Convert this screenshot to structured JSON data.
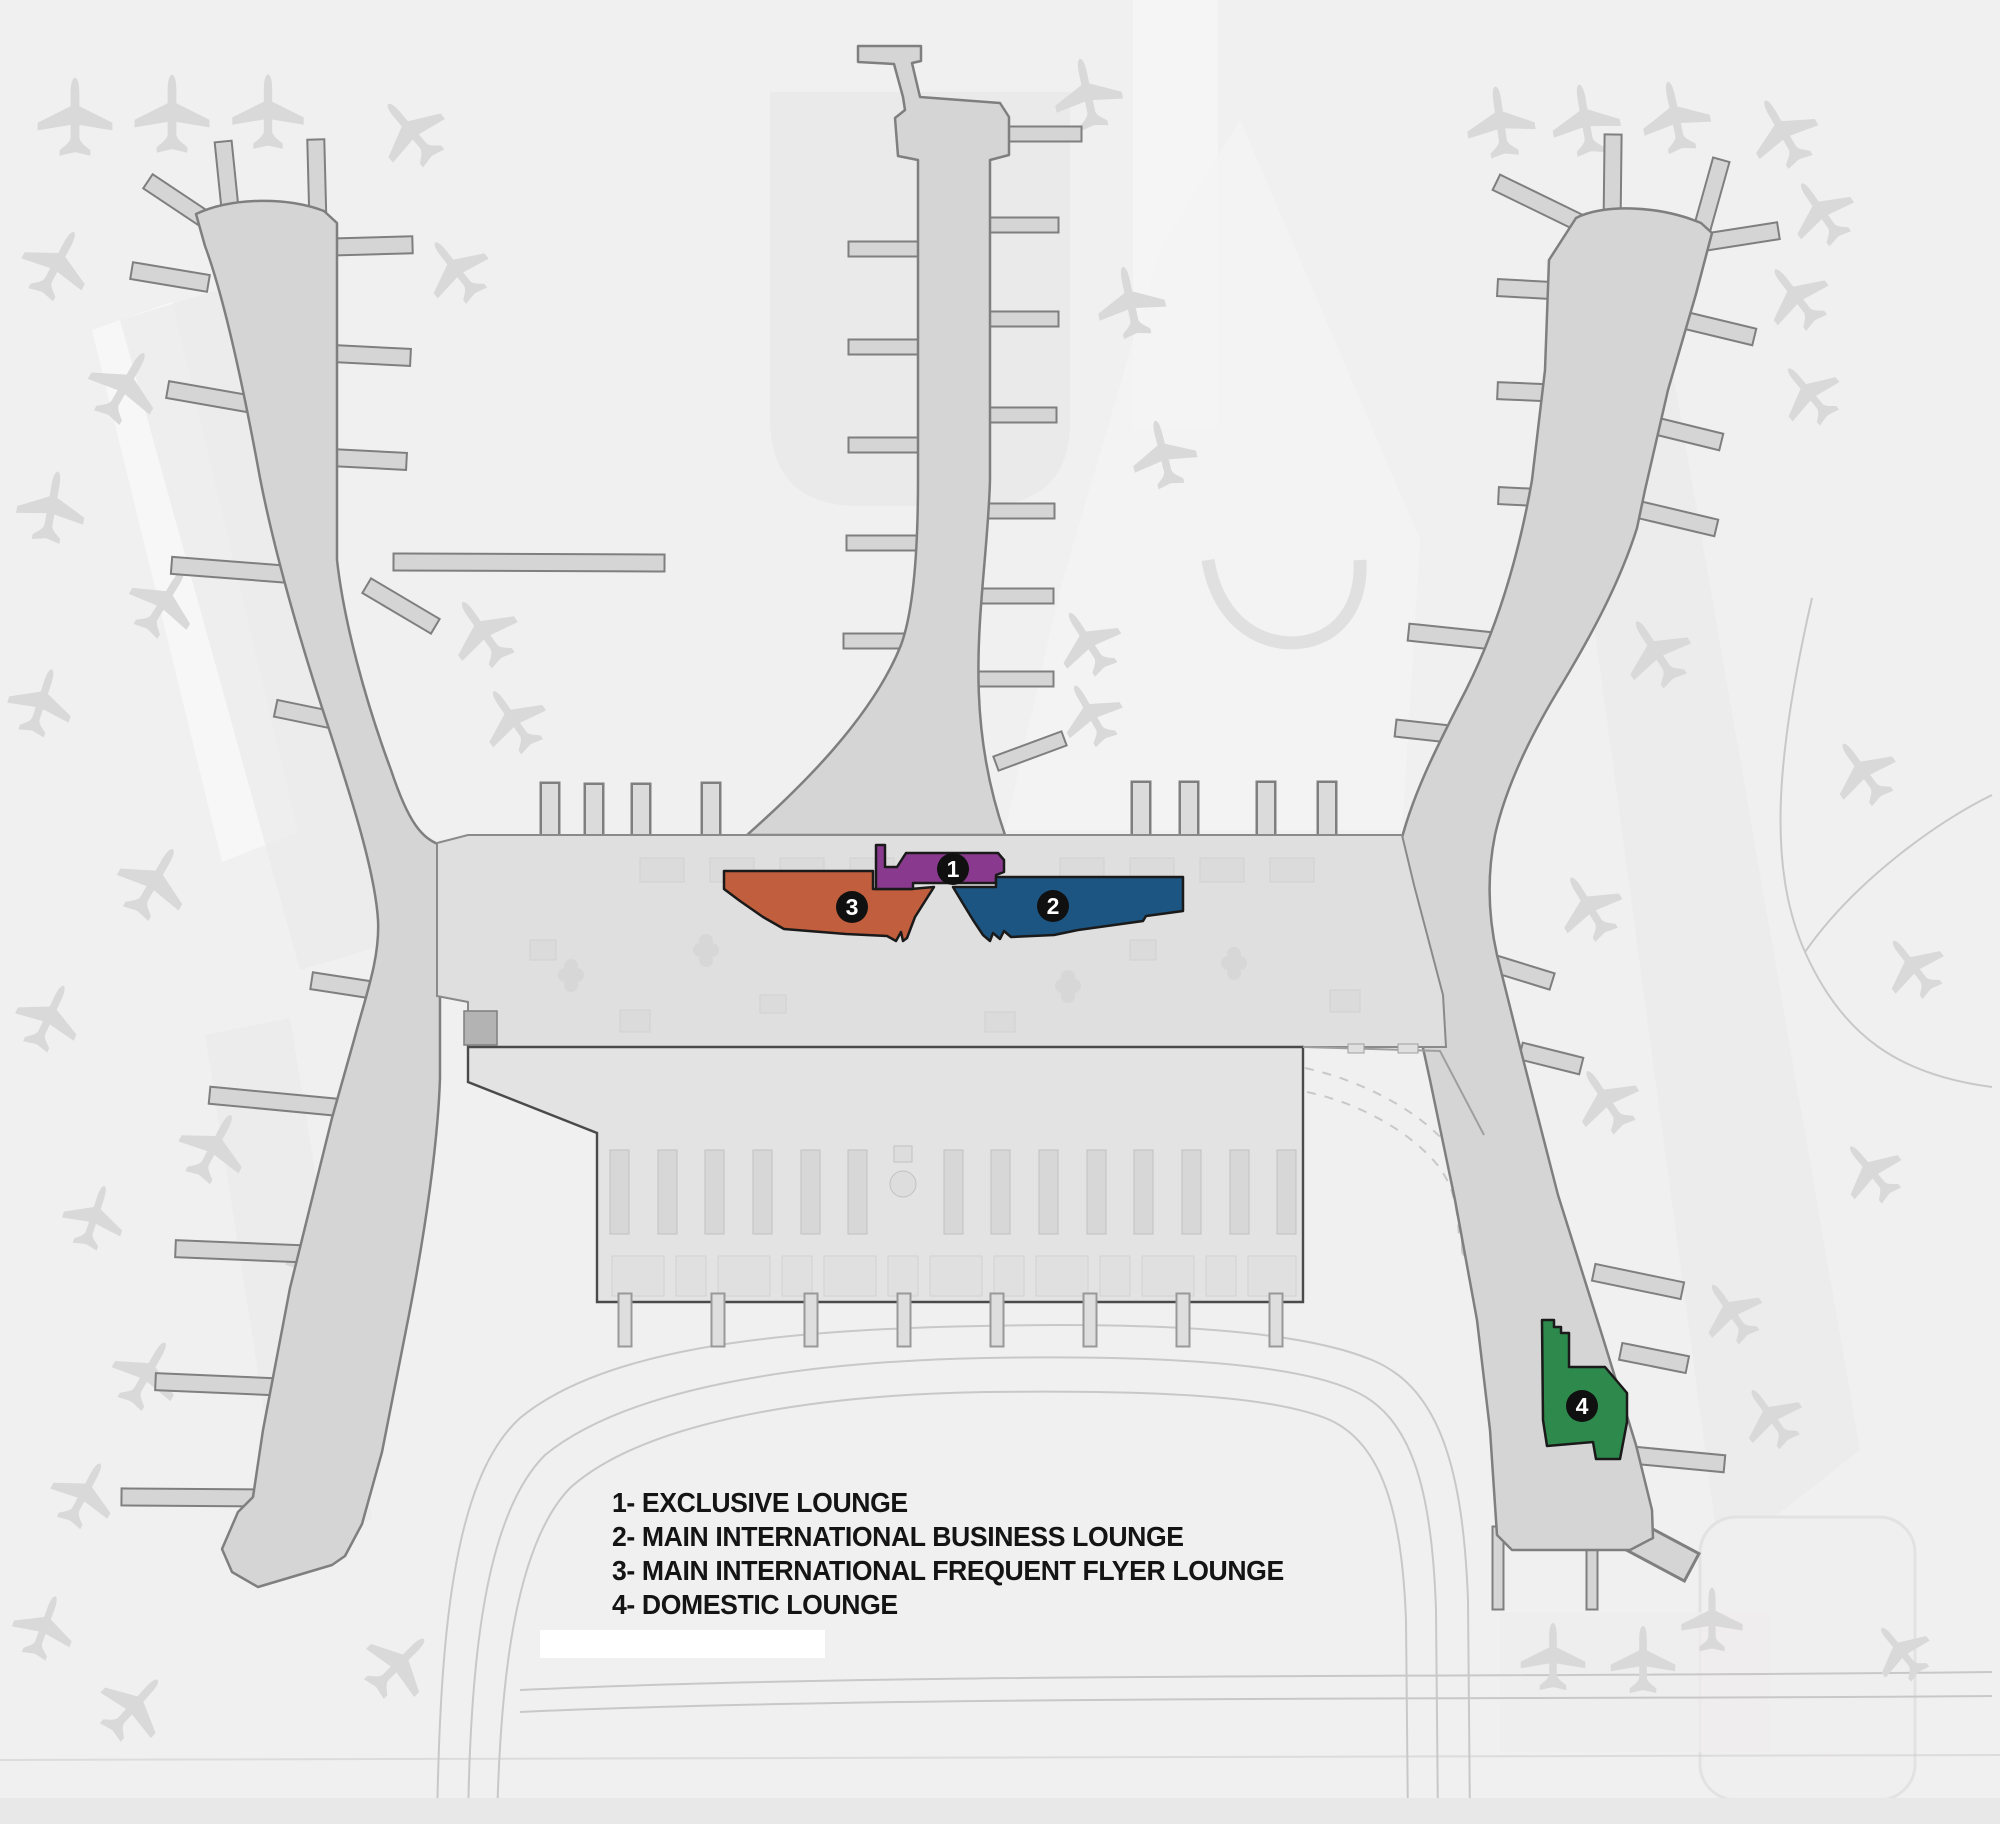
{
  "page": {
    "background": "#f1f0f0",
    "description": "Airport terminal floor-plan map with numbered lounge locations"
  },
  "legend": {
    "items": [
      {
        "number": "1",
        "text": "1- EXCLUSIVE LOUNGE"
      },
      {
        "number": "2",
        "text": "2- MAIN INTERNATIONAL BUSINESS LOUNGE"
      },
      {
        "number": "3",
        "text": "3- MAIN INTERNATIONAL FREQUENT FLYER LOUNGE"
      },
      {
        "number": "4",
        "text": "4- DOMESTIC LOUNGE"
      }
    ]
  },
  "lounges": [
    {
      "number": "1",
      "name": "EXCLUSIVE LOUNGE",
      "color": "#8a3a8e"
    },
    {
      "number": "2",
      "name": "MAIN INTERNATIONAL BUSINESS LOUNGE",
      "color": "#1d5582"
    },
    {
      "number": "3",
      "name": "MAIN INTERNATIONAL FREQUENT FLYER LOUNGE",
      "color": "#c05e3d"
    },
    {
      "number": "4",
      "name": "DOMESTIC LOUNGE",
      "color": "#2e8a4c"
    }
  ],
  "badge": {
    "background": "#101010",
    "text_color": "#ffffff"
  },
  "map": {
    "icons": {
      "airplane": "airplane-icon"
    },
    "colors": {
      "pier_fill": "#d6d5d5",
      "pier_stroke": "#7f7f7f",
      "hall_fill": "#e0dfdf",
      "checkin_fill": "#e4e3e3",
      "checkin_stroke": "#4a4a4a",
      "airplane": "#dad9d9",
      "road": "#c9c8c8",
      "lounge_outline": "#1a1a1a"
    }
  }
}
